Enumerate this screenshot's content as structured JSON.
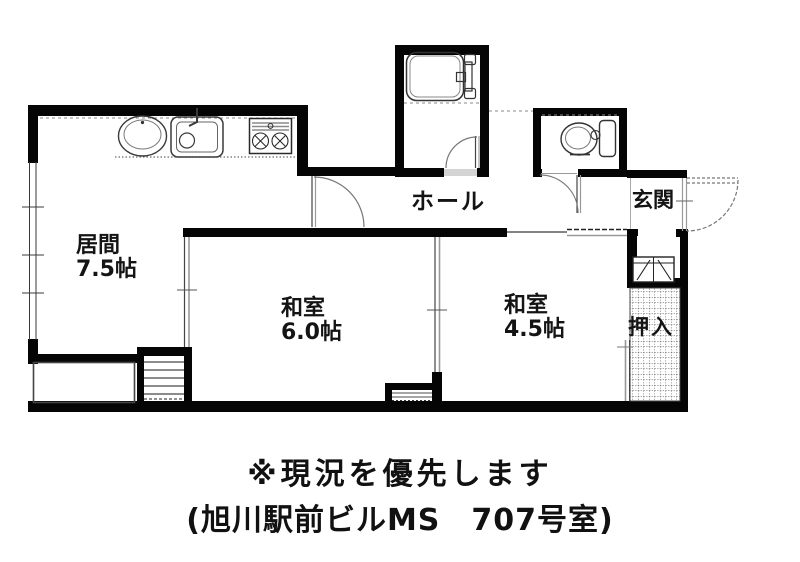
{
  "plan": {
    "rooms": {
      "living": {
        "name": "居間",
        "size": "7.5帖"
      },
      "tatami6": {
        "name": "和室",
        "size": "6.0帖"
      },
      "tatami45": {
        "name": "和室",
        "size": "4.5帖"
      },
      "hall": {
        "name": "ホール"
      },
      "entrance": {
        "name": "玄関"
      },
      "closet": {
        "name": "押入"
      }
    },
    "fixtures": [
      "bathtub",
      "toilet",
      "wash-basin",
      "kitchen-sink",
      "gas-stove",
      "shoe-cabinet",
      "staircase",
      "storage-step",
      "balcony-planter",
      "entrance-door",
      "closet-hatch"
    ],
    "colors": {
      "wall": "#050505",
      "text": "#141414",
      "fixture_line": "#3a3a3a",
      "light_line": "#999999"
    }
  },
  "caption": {
    "line1": "※現況を優先します",
    "line2": "(旭川駅前ビルMS　707号室)"
  }
}
